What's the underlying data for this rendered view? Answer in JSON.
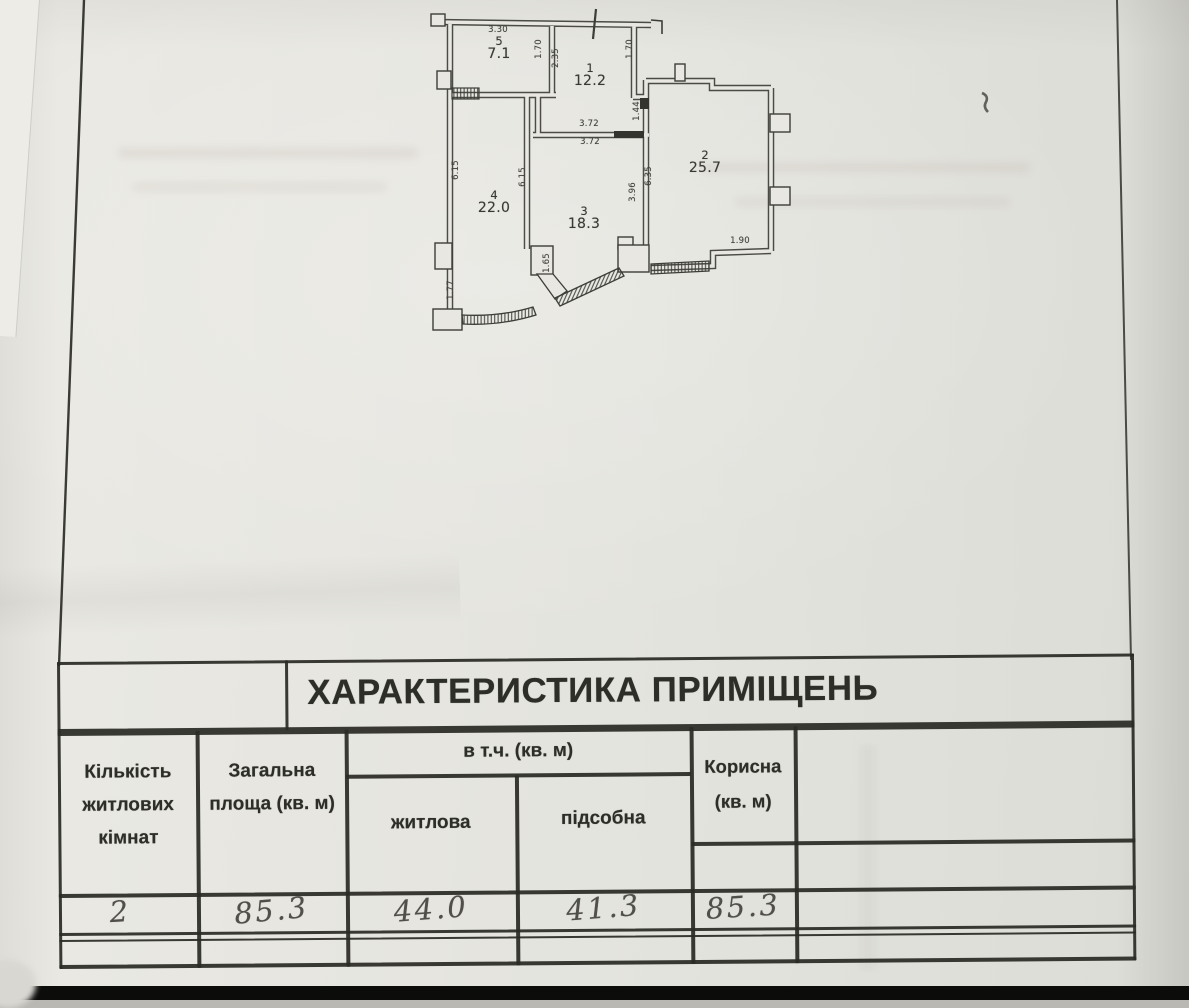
{
  "table": {
    "title": "ХАРАКТЕРИСТИКА ПРИМІЩЕНЬ",
    "headers": {
      "rooms_count": "Кількість житлових кімнат",
      "total_area": "Загальна площа (кв. м)",
      "including": "в т.ч. (кв. м)",
      "living": "житлова",
      "utility": "підсобна",
      "useful": "Корисна (кв. м)"
    },
    "row": {
      "rooms_count": "2",
      "total_area": "85.3",
      "living_area": "44.0",
      "utility_area": "41.3",
      "useful_area": "85.3"
    }
  },
  "floor_plan": {
    "rooms": [
      {
        "number": "5",
        "area": "7.1"
      },
      {
        "number": "1",
        "area": "12.2"
      },
      {
        "number": "2",
        "area": "25.7"
      },
      {
        "number": "4",
        "area": "22.0"
      },
      {
        "number": "3",
        "area": "18.3"
      }
    ],
    "dimensions": {
      "top_width": "3.30",
      "wall_5_1_a": "1.70",
      "wall_5_1_b": "2.35",
      "room1_right": "1.70",
      "room1_right_lower": "1.44",
      "room1_bottom_above": "3.72",
      "room1_bottom_below": "3.72",
      "left_wall": "6.15",
      "wall_4_3": "6.15",
      "wall_3_2": "6.35",
      "room3_right": "3.96",
      "room2_bottom": "1.90",
      "bay_pillar": "1.65",
      "left_wall_lower": "1.77"
    }
  },
  "colors": {
    "paper": "#e7e6e0",
    "ink": "#2b2b26",
    "pencil": "#504f49"
  }
}
